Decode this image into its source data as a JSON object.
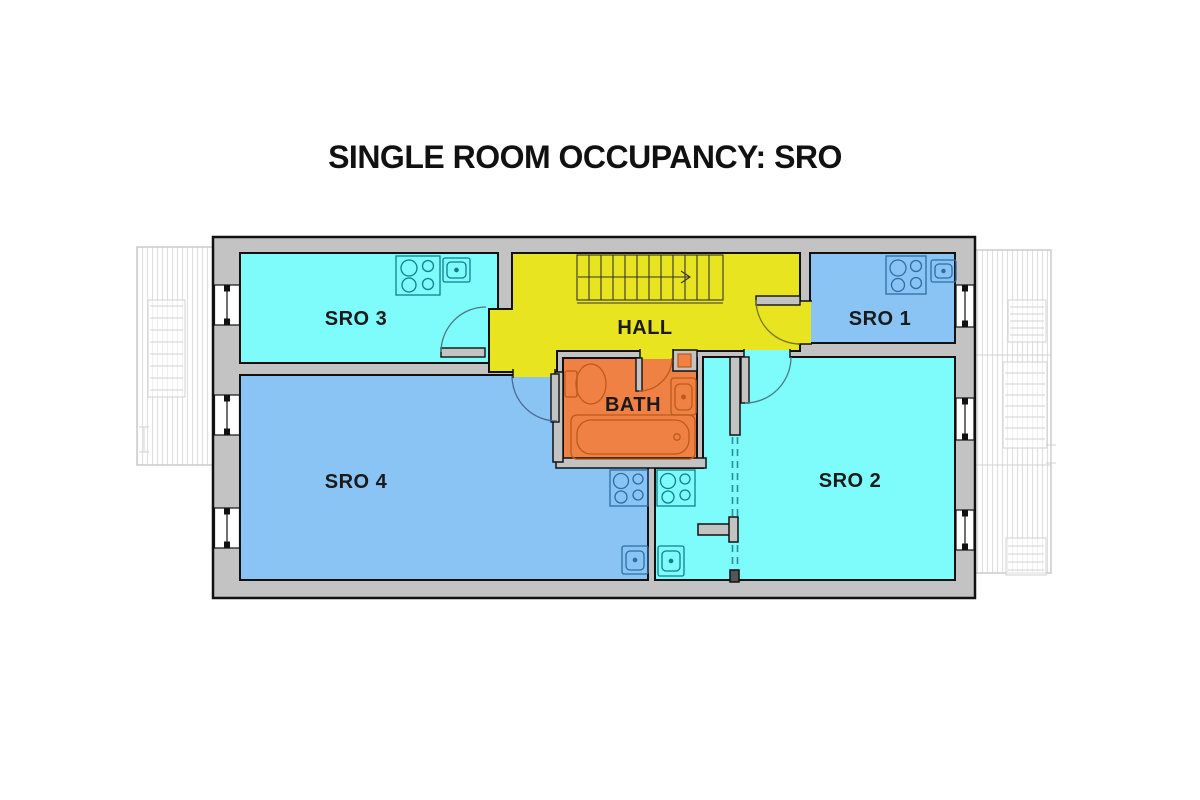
{
  "title": "SINGLE ROOM OCCUPANCY: SRO",
  "rooms": {
    "sro3": {
      "label": "SRO 3",
      "color": "#7efbfb"
    },
    "hall": {
      "label": "HALL",
      "color": "#e8e41f"
    },
    "sro1": {
      "label": "SRO 1",
      "color": "#89c4f4"
    },
    "sro4": {
      "label": "SRO 4",
      "color": "#89c4f4"
    },
    "bath": {
      "label": "BATH",
      "color": "#f08145"
    },
    "sro2": {
      "label": "SRO 2",
      "color": "#7efbfb"
    }
  },
  "palette": {
    "wall": "#c3c3c3",
    "outline": "#111111",
    "window": "#ffffff",
    "deck_line": "#d9d9d9",
    "dashed_partition": "#2a8f9d",
    "fixture_on_cyan": "#117e8e",
    "fixture_on_blue": "#2e6da4",
    "fixture_on_orange": "#bc5a17",
    "stair_line": "#333333"
  },
  "fixtures": {
    "sro3": [
      "stove-icon",
      "sink-icon"
    ],
    "sro1": [
      "stove-icon",
      "sink-icon"
    ],
    "sro4": [
      "stove-icon",
      "sink-icon"
    ],
    "sro2": [
      "stove-icon",
      "sink-icon"
    ],
    "bath": [
      "toilet-icon",
      "sink-icon",
      "bathtub-icon"
    ],
    "hall": [
      "staircase-icon",
      "stair-direction-arrow"
    ]
  },
  "windows": {
    "left_count": 3,
    "right_count": 3
  },
  "exterior": {
    "left_deck": "deck-with-stairs",
    "right_deck": "deck-with-stairs"
  }
}
